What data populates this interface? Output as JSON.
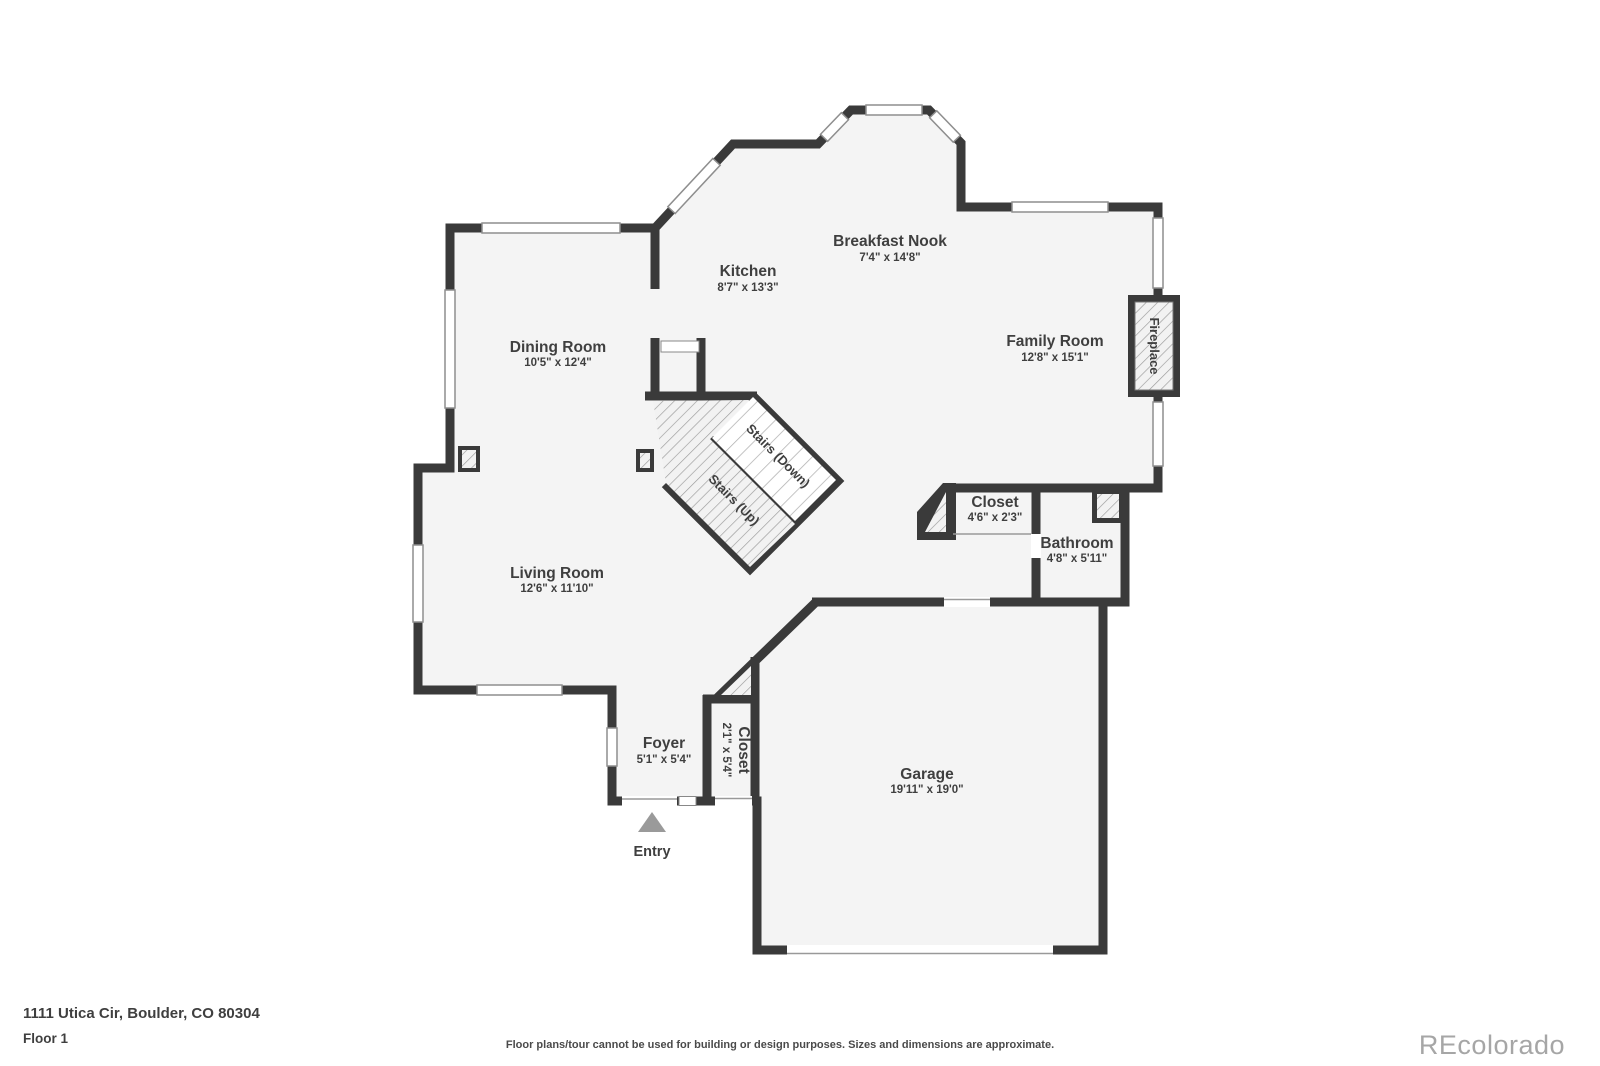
{
  "page": {
    "address": "1111 Utica Cir, Boulder, CO 80304",
    "floor_label": "Floor 1",
    "disclaimer": "Floor plans/tour cannot be used for building or design purposes. Sizes and dimensions are approximate.",
    "watermark": "REcolorado"
  },
  "plan": {
    "entry_label": "Entry",
    "fireplace_label": "Fireplace",
    "stairs_down_label": "Stairs (Down)",
    "stairs_up_label": "Stairs (Up)",
    "rooms": [
      {
        "id": "breakfast-nook",
        "name": "Breakfast Nook",
        "dims": "7'4\" x 14'8\""
      },
      {
        "id": "kitchen",
        "name": "Kitchen",
        "dims": "8'7\" x 13'3\""
      },
      {
        "id": "dining-room",
        "name": "Dining Room",
        "dims": "10'5\" x 12'4\""
      },
      {
        "id": "family-room",
        "name": "Family Room",
        "dims": "12'8\" x 15'1\""
      },
      {
        "id": "living-room",
        "name": "Living Room",
        "dims": "12'6\" x 11'10\""
      },
      {
        "id": "hall-closet",
        "name": "Closet",
        "dims": "4'6\" x 2'3\""
      },
      {
        "id": "bathroom",
        "name": "Bathroom",
        "dims": "4'8\" x 5'11\""
      },
      {
        "id": "foyer",
        "name": "Foyer",
        "dims": "5'1\" x 5'4\""
      },
      {
        "id": "foyer-closet",
        "name": "Closet",
        "dims": "2'1\" x 5'4\""
      },
      {
        "id": "garage",
        "name": "Garage",
        "dims": "19'11\" x 19'0\""
      }
    ],
    "colors": {
      "wall": "#3a3a3a",
      "floor": "#f4f4f4",
      "label_text": "#3f3f3f",
      "window_frame": "#8e8e8e",
      "hatch_line": "#9a9a9a",
      "entry_arrow": "#9a9a9a",
      "watermark_text": "#a6a6a6"
    }
  }
}
